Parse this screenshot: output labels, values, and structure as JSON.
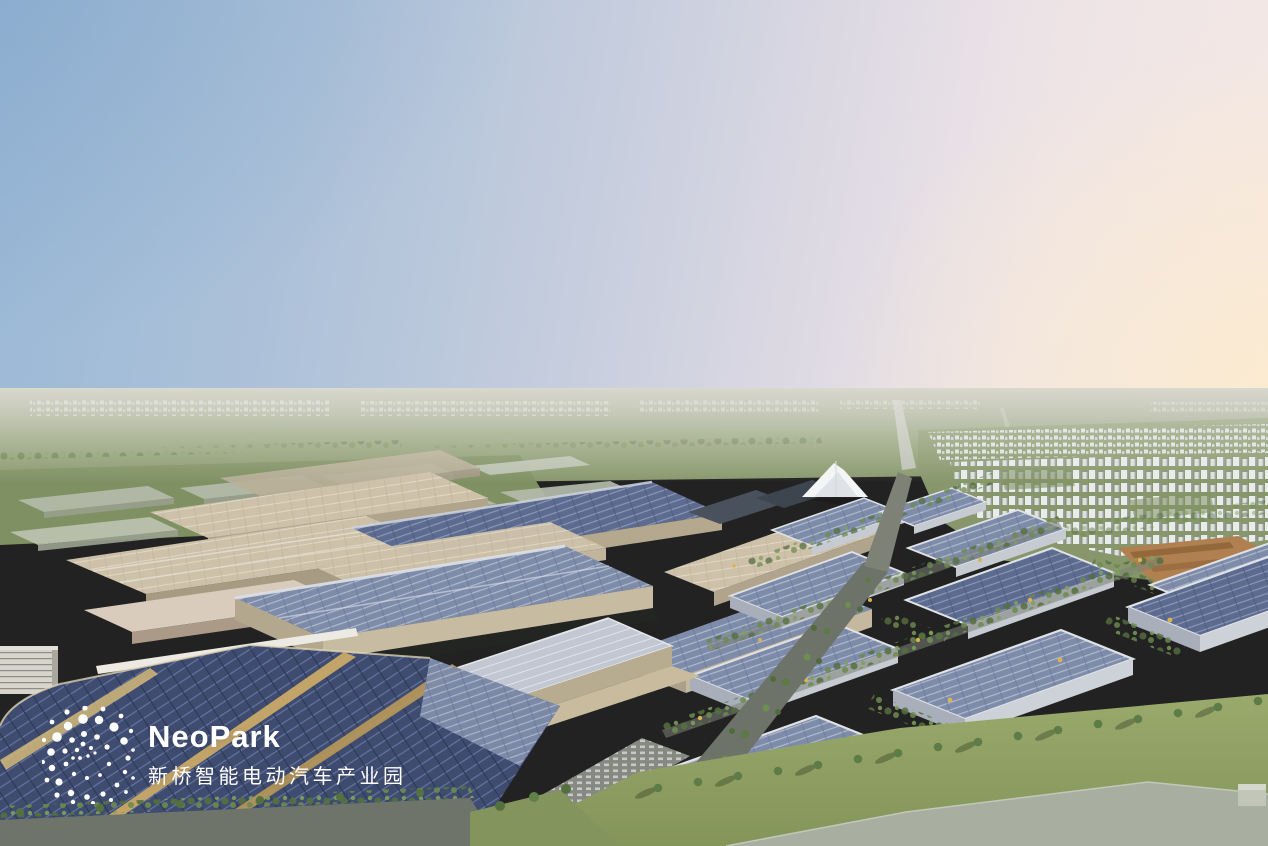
{
  "logo": {
    "brand": "NeoPark",
    "subtitle_zh": "新桥智能电动汽车产业园",
    "mark": "dotted-globe"
  },
  "scene": {
    "alt": "Aerial dusk rendering of the NeoPark intelligent electric vehicle industrial park: solar-roofed factories and warehouses, tree-lined avenues, a white tent landmark, residential towers and green fields stretching to the horizon"
  },
  "palette": {
    "logo_text": "#ffffff",
    "sky_top_left": "#9ab8d6",
    "sky_center": "#ddd9e3",
    "sky_right_glow": "#fbeed5",
    "horizon_plain": "#a6af95",
    "field_green": "#8a9a6e",
    "tree_green": "#5d7c46",
    "factory_wall_beige": "#c7bba1",
    "roof_beige": "#cdc1aa",
    "solar_roof_blue": "#7e8caa",
    "solar_roof_dark": "#5d6b90",
    "solar_roof_navy": "#3f4c70",
    "gold_trim": "#c9a967",
    "residential_white": "#edf0f1",
    "terracotta_campus": "#b08050",
    "road_gray": "#6e7369",
    "lawn_green": "#93a466",
    "concrete_pad": "#a8aea0"
  }
}
